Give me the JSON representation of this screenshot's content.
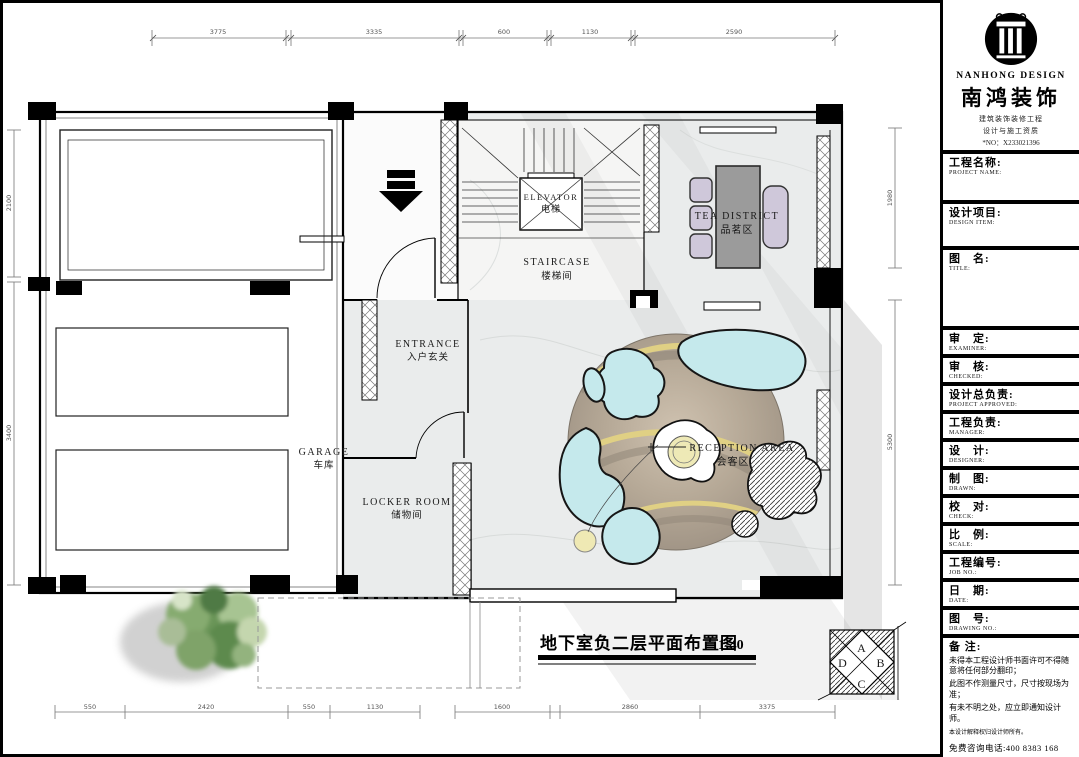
{
  "title_block": {
    "brand": {
      "logo_icon": "column-logo-icon",
      "name_en": "NANHONG DESIGN",
      "name_cn": "南鸿装饰",
      "sub1": "建筑装饰装修工程",
      "sub2": "设计与施工资质",
      "no": "*NO：X233021396"
    },
    "fields": [
      {
        "cn": "工程名称:",
        "en": "PROJECT NAME:"
      },
      {
        "cn": "设计项目:",
        "en": "DESIGN ITEM:"
      },
      {
        "cn": "图　名:",
        "en": "TITLE:"
      },
      {
        "cn": "审　定:",
        "en": "EXAMINER:"
      },
      {
        "cn": "审　核:",
        "en": "CHECKED:"
      },
      {
        "cn": "设计总负责:",
        "en": "PROJECT APPROVED:"
      },
      {
        "cn": "工程负责:",
        "en": "MANAGER:"
      },
      {
        "cn": "设　计:",
        "en": "DESIGNER:"
      },
      {
        "cn": "制　图:",
        "en": "DRAWN:"
      },
      {
        "cn": "校　对:",
        "en": "CHECK:"
      },
      {
        "cn": "比　例:",
        "en": "SCALE:"
      },
      {
        "cn": "工程编号:",
        "en": "JOB NO.:"
      },
      {
        "cn": "日　期:",
        "en": "DATE:"
      },
      {
        "cn": "图　号:",
        "en": "DRAWING NO.:"
      }
    ],
    "notes": {
      "label": "备 注:",
      "lines": [
        "未得本工程设计师书面许可不得随意将任何部分翻印；",
        "此图不作测量尺寸，尺寸按现场为准；",
        "有未不明之处，应立即通知设计师。"
      ],
      "tiny": "本设计解释权归设计师所有。",
      "hotline": "免费咨询电话:400 8383 168"
    }
  },
  "plan": {
    "caption": {
      "cn": "地下室负二层平面布置图",
      "scale": "1:40"
    },
    "rooms": {
      "garage": {
        "en": "GARAGE",
        "cn": "车库"
      },
      "entrance": {
        "en": "ENTRANCE",
        "cn": "入户玄关"
      },
      "locker": {
        "en": "LOCKER  ROOM",
        "cn": "储物间"
      },
      "staircase": {
        "en": "STAIRCASE",
        "cn": "楼梯间"
      },
      "elevator": {
        "en": "ELEVATOR",
        "cn": "电梯"
      },
      "tea": {
        "en": "TEA  DISTRICT",
        "cn": "品茗区"
      },
      "reception": {
        "en": "RECEPTION  AREA",
        "cn": "会客区"
      }
    },
    "compass": {
      "a": "A",
      "b": "B",
      "c": "C",
      "d": "D"
    },
    "dims": {
      "top": [
        "3775",
        "3335",
        "600",
        "1130",
        "2590"
      ],
      "bottom": [
        "550",
        "2420",
        "550",
        "1130",
        "1600",
        "2860",
        "3375"
      ],
      "left": [
        "2100",
        "3400"
      ],
      "right": [
        "1980",
        "5300"
      ]
    },
    "colors": {
      "sofa": "#c5e9ec",
      "furniture_lilac": "#cfc8da",
      "table_gray": "#9b9b9b",
      "rug_tan": "#b5a896",
      "rug_band_yellow": "#e0d084",
      "floor_marble": "#eaecec"
    }
  }
}
